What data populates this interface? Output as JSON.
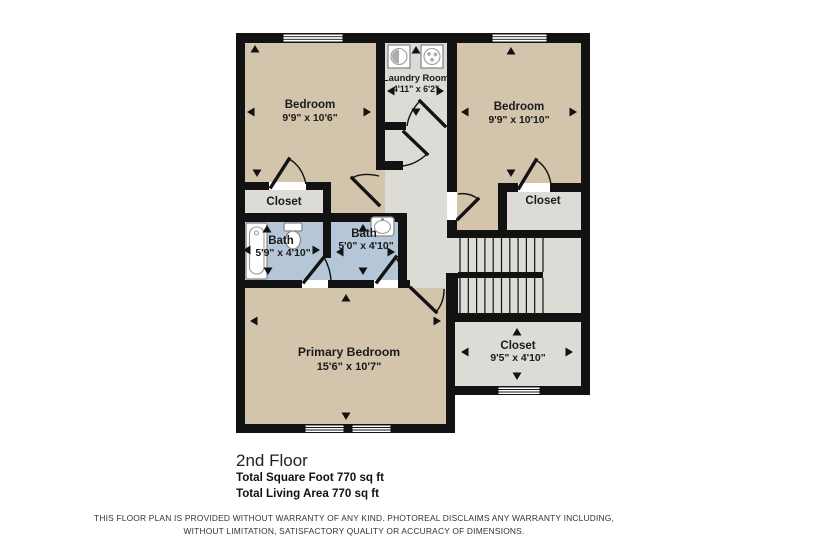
{
  "floorplan": {
    "colors": {
      "wall": "#121212",
      "floor_tan": "#d2c5ab",
      "floor_gray": "#dcdbd6",
      "floor_blue": "#b5c6d8",
      "text": "#1a1a1a"
    },
    "rooms": {
      "bedroom_left": {
        "name": "Bedroom",
        "dims": "9'9\" x 10'6\""
      },
      "laundry": {
        "name": "Laundry Room",
        "dims": "4'11\" x 6'2\""
      },
      "bedroom_right": {
        "name": "Bedroom",
        "dims": "9'9\" x 10'10\""
      },
      "closet_left": {
        "name": "Closet"
      },
      "closet_right": {
        "name": "Closet"
      },
      "bath_left": {
        "name": "Bath",
        "dims": "5'9\" x 4'10\""
      },
      "bath_right": {
        "name": "Bath",
        "dims": "5'0\" x 4'10\""
      },
      "primary_bedroom": {
        "name": "Primary Bedroom",
        "dims": "15'6\" x 10'7\""
      },
      "closet_bottom": {
        "name": "Closet",
        "dims": "9'5\" x 4'10\""
      }
    },
    "icons": {
      "washer": "washer-icon",
      "dryer": "dryer-icon",
      "bathtub": "bathtub-icon",
      "toilet": "toilet-icon",
      "sink": "sink-icon"
    },
    "footer": {
      "floor_label": "2nd Floor",
      "total_square_foot": "Total Square Foot 770 sq ft",
      "total_living_area": "Total Living Area 770 sq ft"
    },
    "disclaimer": {
      "line1": "THIS FLOOR PLAN IS PROVIDED WITHOUT WARRANTY OF ANY KIND. PHOTOREAL DISCLAIMS ANY WARRANTY INCLUDING,",
      "line2": "WITHOUT LIMITATION, SATISFACTORY QUALITY OR ACCURACY OF DIMENSIONS."
    }
  }
}
